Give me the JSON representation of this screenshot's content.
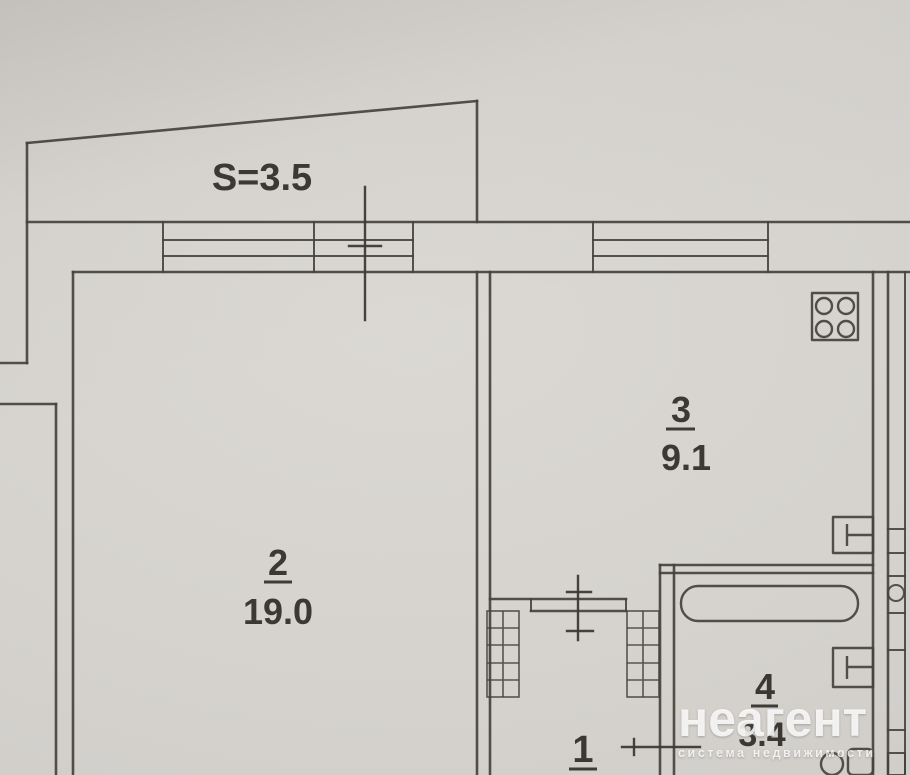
{
  "plan": {
    "balcony": {
      "area_label": "S=3.5"
    },
    "rooms": [
      {
        "id": "room-2",
        "number": "2",
        "area": "19.0"
      },
      {
        "id": "room-3",
        "number": "3",
        "area": "9.1"
      },
      {
        "id": "room-4",
        "number": "4",
        "area": "3.4"
      },
      {
        "id": "room-1",
        "number": "1"
      }
    ],
    "symbols": [
      "stove-icon",
      "sink-icon",
      "bathtub-icon",
      "toilet-icon",
      "built-in-closet",
      "window-band",
      "doorway-marker",
      "vent-shaft"
    ]
  },
  "watermark": {
    "brand": "неагент",
    "tagline": "система недвижимости"
  },
  "colors": {
    "paper": "#d5d2ce",
    "line": "#45423e",
    "label_text": "#2f2c28",
    "watermark_text": "#ffffff"
  }
}
